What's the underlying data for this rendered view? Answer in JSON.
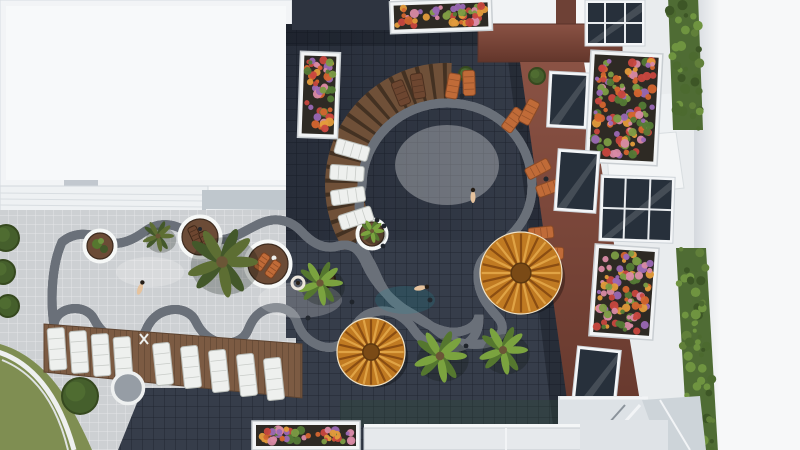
{
  "meta": {
    "alt_text": "Aerial top-down view of a resort courtyard with a curvy turquoise lazy-river pool connecting to a large round pool, surrounded by dark tile deck, wooden sun decks, loungers, palm trees, round wicker umbrellas, white buildings with flower planter balconies and green hedges"
  },
  "colors": {
    "bg": "#f6f7f8",
    "roof_white": "#f2f4f6",
    "roof_inner": "#f7f9fa",
    "pavement": "#cdd0d3",
    "deck": "#363d4a",
    "wood": "#7c5b43",
    "wood_ring": "#6f5038",
    "wood_ring_gap": "#433122",
    "wall_brown": "#6e4136",
    "grass": "#7f8e52",
    "hedge": "#4f6c34",
    "water_main_light": "#c6ebe6",
    "water_main_mid": "#9fdfdd",
    "water_main_deep": "#74ccd2",
    "water_lazy_left": "#a5e0de",
    "water_lazy_mid": "#7fd4d8",
    "water_lazy_right": "#62c8d2",
    "rim_white": "#f6f8f7",
    "rim_halo": "#6a7079",
    "umbrella": "#c07a22",
    "umbrella_spoke_dark": "#8a4d12",
    "umbrella_spoke_light": "#e0a345",
    "lounger_white": "#eef0ee",
    "lounger_orange": "#c06b38",
    "lounger_brown": "#6d4630",
    "soil": "#2e2a24",
    "glass_dark": "#27303b",
    "palm_tones": [
      [
        "#5d6e33",
        "#43582a"
      ],
      [
        "#7ba33f",
        "#55772f"
      ]
    ],
    "flower_palette": [
      "#d4652f",
      "#e39b3b",
      "#7c9c45",
      "#9a68b4",
      "#c8473f",
      "#547a36",
      "#d98aa5"
    ]
  },
  "scene": {
    "palms": [
      {
        "x": 222,
        "y": 262,
        "r": 36,
        "tone": 0
      },
      {
        "x": 158,
        "y": 236,
        "r": 16,
        "tone": 0
      },
      {
        "x": 320,
        "y": 283,
        "r": 23,
        "tone": 1
      },
      {
        "x": 372,
        "y": 231,
        "r": 12,
        "tone": 1
      },
      {
        "x": 440,
        "y": 356,
        "r": 27,
        "tone": 1
      },
      {
        "x": 503,
        "y": 350,
        "r": 25,
        "tone": 1
      },
      {
        "x": 128,
        "y": 387,
        "r": 14,
        "tone": 0
      }
    ],
    "umbrellas": [
      {
        "x": 521,
        "y": 273,
        "r": 41
      },
      {
        "x": 371,
        "y": 352,
        "r": 34
      }
    ],
    "bushes": [
      {
        "x": 6,
        "y": 238,
        "r": 13
      },
      {
        "x": 3,
        "y": 272,
        "r": 12
      },
      {
        "x": 8,
        "y": 306,
        "r": 11
      },
      {
        "x": 80,
        "y": 396,
        "r": 18
      },
      {
        "x": 537,
        "y": 76,
        "r": 8
      },
      {
        "x": 466,
        "y": 74,
        "r": 7
      }
    ],
    "islands": [
      {
        "x": 100,
        "y": 246,
        "r": 13,
        "kind": "green"
      },
      {
        "x": 200,
        "y": 237,
        "r": 18,
        "kind": "deck2"
      },
      {
        "x": 268,
        "y": 264,
        "r": 20,
        "kind": "deck3"
      },
      {
        "x": 372,
        "y": 234,
        "r": 12,
        "kind": "plain"
      }
    ],
    "tables": [
      {
        "x": 327,
        "y": 279,
        "r": 8
      }
    ],
    "stools": [
      {
        "x": 462,
        "y": 96
      },
      {
        "x": 521,
        "y": 127
      },
      {
        "x": 546,
        "y": 179
      },
      {
        "x": 430,
        "y": 300
      },
      {
        "x": 308,
        "y": 318
      }
    ],
    "loungers": {
      "ring_white": [
        {
          "x": 356,
          "y": 218,
          "rot": 72
        },
        {
          "x": 348,
          "y": 196,
          "rot": 82
        },
        {
          "x": 347,
          "y": 173,
          "rot": 94
        },
        {
          "x": 352,
          "y": 150,
          "rot": 106
        }
      ],
      "ring_brown": [
        {
          "x": 401,
          "y": 93,
          "rot": -22
        },
        {
          "x": 418,
          "y": 86,
          "rot": -10
        }
      ],
      "pool_orange": [
        {
          "x": 453,
          "y": 86,
          "rot": 10
        },
        {
          "x": 469,
          "y": 83,
          "rot": -2
        },
        {
          "x": 513,
          "y": 120,
          "rot": 36
        },
        {
          "x": 529,
          "y": 112,
          "rot": 28
        },
        {
          "x": 538,
          "y": 169,
          "rot": 62
        },
        {
          "x": 549,
          "y": 188,
          "rot": 70
        },
        {
          "x": 541,
          "y": 233,
          "rot": 84
        },
        {
          "x": 551,
          "y": 253,
          "rot": 92
        }
      ],
      "row_left": [
        {
          "x": 57,
          "y": 349,
          "rot": -4
        },
        {
          "x": 79,
          "y": 352,
          "rot": -4
        },
        {
          "x": 101,
          "y": 355,
          "rot": -4
        },
        {
          "x": 123,
          "y": 358,
          "rot": -4
        }
      ],
      "row_right": [
        {
          "x": 163,
          "y": 364,
          "rot": -6
        },
        {
          "x": 191,
          "y": 367,
          "rot": -6
        },
        {
          "x": 219,
          "y": 371,
          "rot": -6
        },
        {
          "x": 247,
          "y": 375,
          "rot": -6
        },
        {
          "x": 274,
          "y": 379,
          "rot": -6
        }
      ]
    },
    "planters": [
      {
        "x": 390,
        "y": 0,
        "w": 102,
        "h": 32,
        "rot": -2
      },
      {
        "x": 299,
        "y": 52,
        "w": 40,
        "h": 86,
        "rot": 2
      },
      {
        "x": 588,
        "y": 52,
        "w": 72,
        "h": 112,
        "rot": 3
      },
      {
        "x": 592,
        "y": 246,
        "w": 64,
        "h": 92,
        "rot": 4
      },
      {
        "x": 252,
        "y": 421,
        "w": 108,
        "h": 29,
        "rot": 0
      }
    ],
    "windows": [
      {
        "x": 585,
        "y": 0,
        "w": 60,
        "h": 46,
        "mull": true,
        "rot": 0
      },
      {
        "x": 600,
        "y": 176,
        "w": 74,
        "h": 66,
        "mull": true,
        "rot": 2
      },
      {
        "x": 548,
        "y": 72,
        "w": 40,
        "h": 56,
        "mull": false,
        "rot": 3
      },
      {
        "x": 556,
        "y": 150,
        "w": 42,
        "h": 62,
        "mull": false,
        "rot": 4
      },
      {
        "x": 574,
        "y": 348,
        "w": 44,
        "h": 66,
        "mull": false,
        "rot": 6
      }
    ],
    "hedges": [
      {
        "x": 668,
        "y": -4,
        "w": 30,
        "h": 134,
        "tilt": 5
      },
      {
        "x": 676,
        "y": 248,
        "w": 30,
        "h": 204,
        "tilt": 12
      }
    ],
    "people": [
      {
        "x": 473,
        "y": 197,
        "t": "swim",
        "rot": 0
      },
      {
        "x": 420,
        "y": 288,
        "t": "swim",
        "rot": 80
      },
      {
        "x": 140,
        "y": 289,
        "t": "swim",
        "rot": 20
      },
      {
        "x": 298,
        "y": 283,
        "t": "float",
        "rot": 0
      },
      {
        "x": 383,
        "y": 246,
        "t": "dot",
        "rot": 0
      },
      {
        "x": 352,
        "y": 302,
        "t": "dot",
        "rot": 0
      },
      {
        "x": 377,
        "y": 220,
        "t": "dot",
        "rot": 0
      },
      {
        "x": 384,
        "y": 226,
        "t": "dot",
        "rot": 0
      },
      {
        "x": 466,
        "y": 346,
        "t": "dot",
        "rot": 0
      }
    ]
  }
}
